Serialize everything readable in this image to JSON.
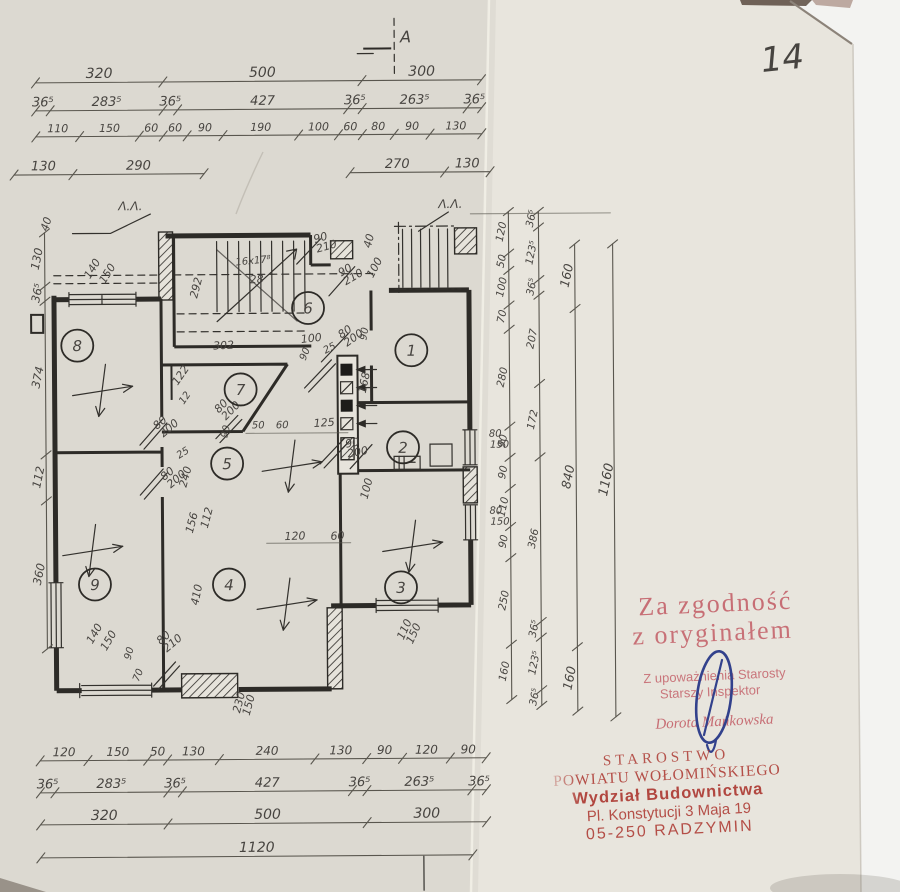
{
  "page": {
    "handwritten_number": "14"
  },
  "section_marks": {
    "top_label": "A",
    "left_label": "Λ.Λ.",
    "right_label": "Λ.Λ."
  },
  "dimensions": {
    "top": {
      "row1": [
        "320",
        "500",
        "300"
      ],
      "row2": [
        "36⁵",
        "283⁵",
        "36⁵",
        "427",
        "36⁵",
        "263⁵",
        "36⁵"
      ],
      "row3": [
        "110",
        "150",
        "60",
        "60",
        "90",
        "190",
        "100",
        "60",
        "80",
        "90",
        "130"
      ],
      "row4_left": [
        "130",
        "290"
      ],
      "row4_right": [
        "270",
        "130"
      ]
    },
    "bottom": {
      "row1": [
        "120",
        "150",
        "50",
        "130",
        "240",
        "130",
        "90",
        "120",
        "90"
      ],
      "row2": [
        "36⁵",
        "283⁵",
        "36⁵",
        "427",
        "36⁵",
        "263⁵",
        "36⁵"
      ],
      "row3": [
        "320",
        "500",
        "300"
      ],
      "row4": [
        "1120"
      ]
    },
    "left": [
      "130",
      "36⁵",
      "374",
      "112",
      "360"
    ],
    "right": {
      "chain1": [
        "120",
        "50",
        "100",
        "70",
        "280",
        "90",
        "90",
        "110",
        "90",
        "250",
        "160"
      ],
      "chain2": [
        "36⁵",
        "123⁵",
        "36⁵",
        "207",
        "172",
        "386",
        "36⁵",
        "123⁵",
        "36⁵"
      ],
      "chain3": [
        "160",
        "840",
        "160"
      ],
      "chain4": [
        "1160"
      ]
    }
  },
  "rooms": [
    "1",
    "2",
    "3",
    "4",
    "5",
    "6",
    "7",
    "8",
    "9"
  ],
  "plan": {
    "stair_note": "16x17⁸ / 28",
    "annotations": [
      {
        "t": "40",
        "x": 49,
        "y": 229,
        "r": -72
      },
      {
        "t": "140",
        "x": 91,
        "y": 277,
        "r": -58
      },
      {
        "t": "150",
        "x": 106,
        "y": 282,
        "r": -58
      },
      {
        "t": "90/210",
        "x": 316,
        "y": 242,
        "r": -15
      },
      {
        "t": "40",
        "x": 372,
        "y": 248,
        "r": -75
      },
      {
        "t": "90/210",
        "x": 342,
        "y": 276,
        "r": -30
      },
      {
        "t": "100",
        "x": 374,
        "y": 278,
        "r": -62
      },
      {
        "t": "16x17⁸",
        "x": 237,
        "y": 264,
        "r": -5,
        "s": 10
      },
      {
        "t": "28",
        "x": 251,
        "y": 282,
        "r": -3
      },
      {
        "t": "292",
        "x": 198,
        "y": 297,
        "r": -75
      },
      {
        "t": "302",
        "x": 214,
        "y": 348,
        "r": -3
      },
      {
        "t": "90",
        "x": 306,
        "y": 360,
        "r": -68,
        "s": 10
      },
      {
        "t": "80/200",
        "x": 342,
        "y": 338,
        "r": -35
      },
      {
        "t": "100",
        "x": 302,
        "y": 342,
        "r": -6
      },
      {
        "t": "25",
        "x": 326,
        "y": 353,
        "r": -28,
        "s": 10
      },
      {
        "t": "90",
        "x": 367,
        "y": 340,
        "r": -80,
        "s": 10
      },
      {
        "t": "168",
        "x": 366,
        "y": 393,
        "r": -78
      },
      {
        "t": "122",
        "x": 178,
        "y": 384,
        "r": -55
      },
      {
        "t": "12",
        "x": 184,
        "y": 403,
        "r": -55,
        "s": 10
      },
      {
        "t": "80/200",
        "x": 219,
        "y": 412,
        "r": -45
      },
      {
        "t": "90",
        "x": 227,
        "y": 437,
        "r": -75,
        "s": 10
      },
      {
        "t": "50",
        "x": 252,
        "y": 427,
        "s": 10
      },
      {
        "t": "60",
        "x": 276,
        "y": 427,
        "s": 10
      },
      {
        "t": "125",
        "x": 314,
        "y": 426,
        "r": -3
      },
      {
        "t": "80/200",
        "x": 157,
        "y": 428,
        "r": -40
      },
      {
        "t": "25",
        "x": 179,
        "y": 457,
        "r": -32,
        "s": 10
      },
      {
        "t": "80/200",
        "x": 164,
        "y": 479,
        "r": -40
      },
      {
        "t": "240",
        "x": 186,
        "y": 486,
        "r": -75
      },
      {
        "t": "156",
        "x": 192,
        "y": 532,
        "r": -75
      },
      {
        "t": "112",
        "x": 207,
        "y": 527,
        "r": -75
      },
      {
        "t": "90/200",
        "x": 346,
        "y": 447,
        "r": -10
      },
      {
        "t": "100",
        "x": 367,
        "y": 499,
        "r": -75
      },
      {
        "t": "120",
        "x": 284,
        "y": 539,
        "r": -2
      },
      {
        "t": "60",
        "x": 330,
        "y": 539,
        "r": -2
      },
      {
        "t": "410",
        "x": 197,
        "y": 604,
        "r": -78
      },
      {
        "t": "140",
        "x": 91,
        "y": 642,
        "r": -60
      },
      {
        "t": "150",
        "x": 105,
        "y": 649,
        "r": -60
      },
      {
        "t": "90",
        "x": 129,
        "y": 658,
        "r": -75,
        "s": 10
      },
      {
        "t": "70",
        "x": 137,
        "y": 680,
        "r": -68,
        "s": 10
      },
      {
        "t": "80/210",
        "x": 159,
        "y": 643,
        "r": -40
      },
      {
        "t": "230/150",
        "x": 238,
        "y": 712,
        "r": -75
      },
      {
        "t": "110/150",
        "x": 402,
        "y": 640,
        "r": -65
      },
      {
        "t": "80",
        "x": 489,
        "y": 437,
        "s": 10
      },
      {
        "t": "150",
        "x": 490,
        "y": 448,
        "s": 10
      },
      {
        "t": "80",
        "x": 489,
        "y": 514,
        "s": 10
      },
      {
        "t": "150",
        "x": 490,
        "y": 525,
        "s": 10
      }
    ]
  },
  "stamps": {
    "certify": {
      "line1": "Za zgodność",
      "line2": "z oryginałem",
      "auth_line1": "Z upoważnienia Starosty",
      "auth_line2": "Starszy Inspektor",
      "signer_name": "Dorota Mańkowska",
      "color": "#c4626a"
    },
    "office": {
      "line1": "STAROSTWO",
      "line2": "POWIATU WOŁOMIŃSKIEGO",
      "line3": "Wydział Budownictwa",
      "line4": "Pl. Konstytucji 3 Maja 19",
      "line5": "05-250 RADZYMIN",
      "color": "#ad3a33"
    }
  },
  "colors": {
    "paper_left": "#dcd9d1",
    "paper_right": "#e8e5dd",
    "backdrop": "#f3f3f1",
    "pencil": "#59564e",
    "print": "#2d2b27",
    "stamp_light_red": "#c4626a",
    "stamp_dark_red": "#ad3a33",
    "pen_blue": "#32418c"
  }
}
